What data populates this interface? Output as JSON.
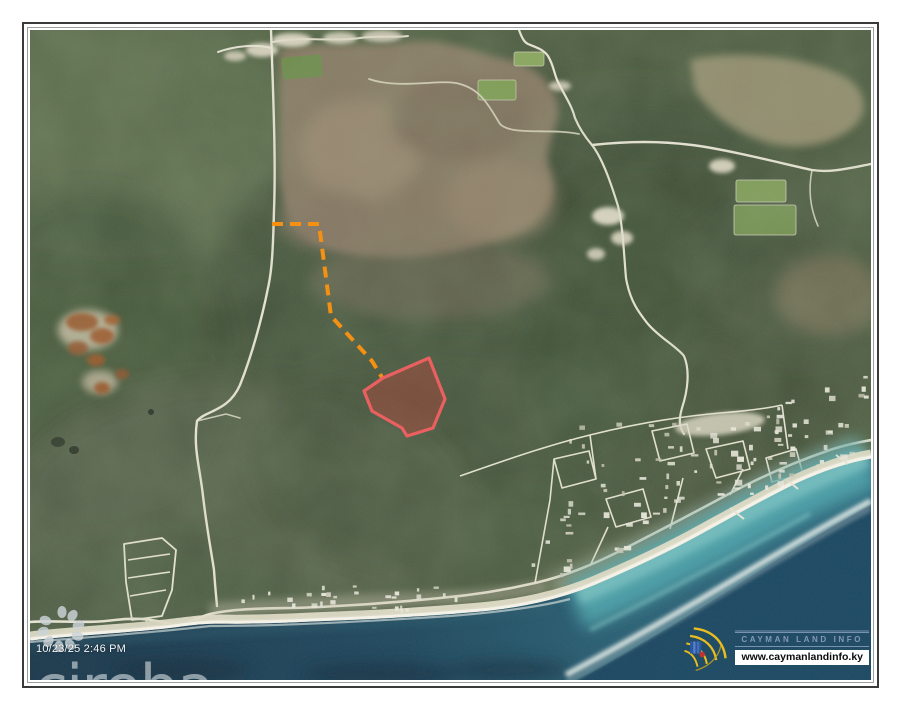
{
  "frame": {
    "outer_border_color": "#3a3a3a",
    "inner_border_color": "#9aa0a2"
  },
  "map": {
    "kind": "satellite-aerial-photo"
  },
  "overlays": {
    "parcel_outline_color": "#ea6060",
    "parcel_fill_color": "rgba(196,66,58,0.38)",
    "access_path_color": "#f49012",
    "access_path_style": "dashed"
  },
  "watermarks": {
    "brand_text": "cireba",
    "brand_logo_icon": "petal-flower-icon",
    "timestamp": "10/23/25 2:46 PM"
  },
  "provider": {
    "name": "CAYMAN LAND INFO",
    "website": "www.caymanlandinfo.ky",
    "logo_icon": "fan-arcs-icon",
    "accent_yellow": "#e9bd1f",
    "accent_blue": "#2b57a5",
    "accent_red": "#c23430",
    "name_color": "#8398ba"
  }
}
